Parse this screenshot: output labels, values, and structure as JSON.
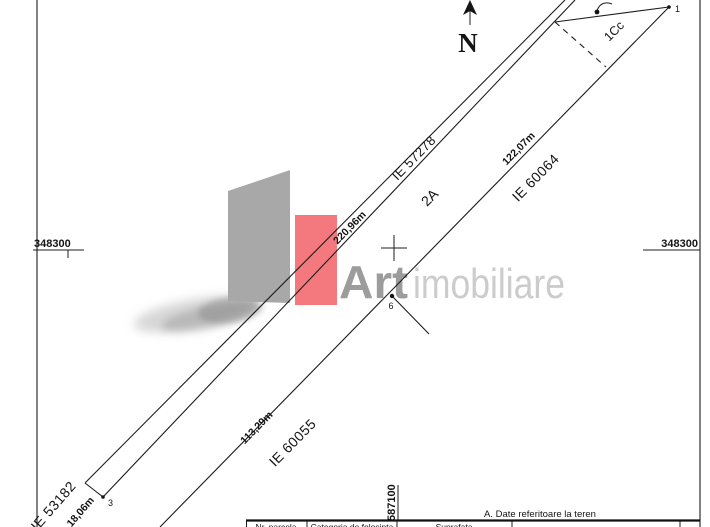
{
  "map": {
    "north": "N",
    "grid": {
      "northing_left": "348300",
      "northing_right": "348300",
      "easting_bottom": "587100"
    },
    "parcel_labels": {
      "main": "2A",
      "secondary": "1Cc"
    },
    "neighbor_labels": {
      "nw": "IE 57278",
      "se_upper": "IE 60064",
      "se_lower": "IE 60055",
      "sw": "IE 53182"
    },
    "dimensions": {
      "nw_length": "220,96m",
      "se_upper_length": "122,07m",
      "se_lower_length": "113,29m",
      "sw_width": "18,06m"
    },
    "points": {
      "p1": "1",
      "p3": "3",
      "p6": "6"
    }
  },
  "watermark": {
    "brand_bold": "Art",
    "brand_light": "imobiliare",
    "accent_color": "#f4797f",
    "gray_color": "#a8a8a8"
  },
  "table": {
    "section_title": "A. Date referitoare la teren",
    "columns": [
      "Nr. parcela",
      "Categoria de folosinta",
      "Suprafata",
      ""
    ]
  }
}
